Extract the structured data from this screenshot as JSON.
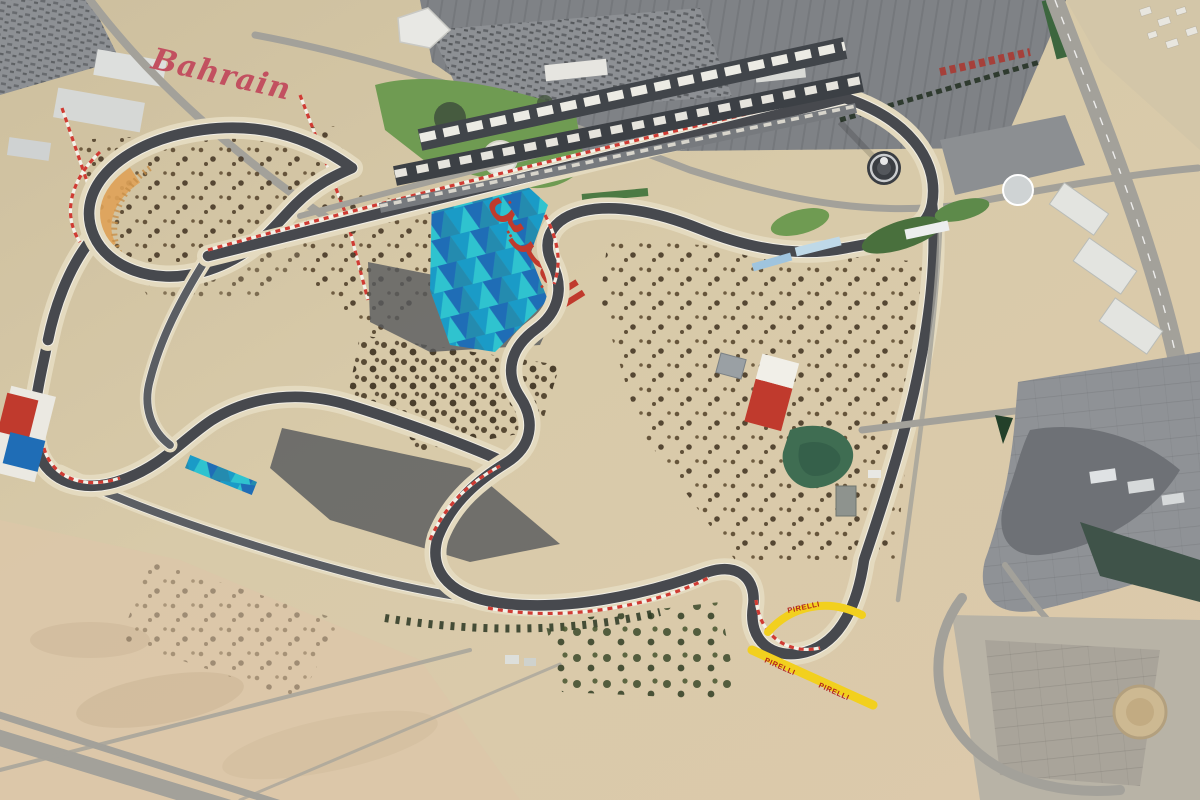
{
  "scene": {
    "labels": {
      "bahrain_ground_text": "Bahrain",
      "arabic_ground_text": "البحرين",
      "pirelli_text": "PIRELLI"
    },
    "colors": {
      "sand": "#d5c6a5",
      "sand_light": "#e4dabf",
      "sand_dark": "#c3ae8b",
      "sand_rose": "#dbc7a9",
      "asphalt": "#47494e",
      "asphalt_light": "#5b5e63",
      "road": "#a3a19a",
      "roof_gray": "#7f8286",
      "lot_gray": "#8d9094",
      "canopy_white": "#ecebe4",
      "mosaic_teal": "#2fc3cf",
      "mosaic_teal_dark": "#1a9bc7",
      "mosaic_blue": "#1f6db6",
      "mosaic_navy": "#19538f",
      "accent_red": "#c03a2d",
      "flower_red": "#c25060",
      "lawn_green": "#6f9b52",
      "hedge_green": "#3c663e",
      "pond_green": "#3f6d52",
      "pirelli_yellow": "#f2d01e",
      "pirelli_red": "#b3231c",
      "kerb_red": "#cf3b33",
      "white_line": "#f2efe6",
      "gravel_orange": "#dfa258"
    }
  }
}
